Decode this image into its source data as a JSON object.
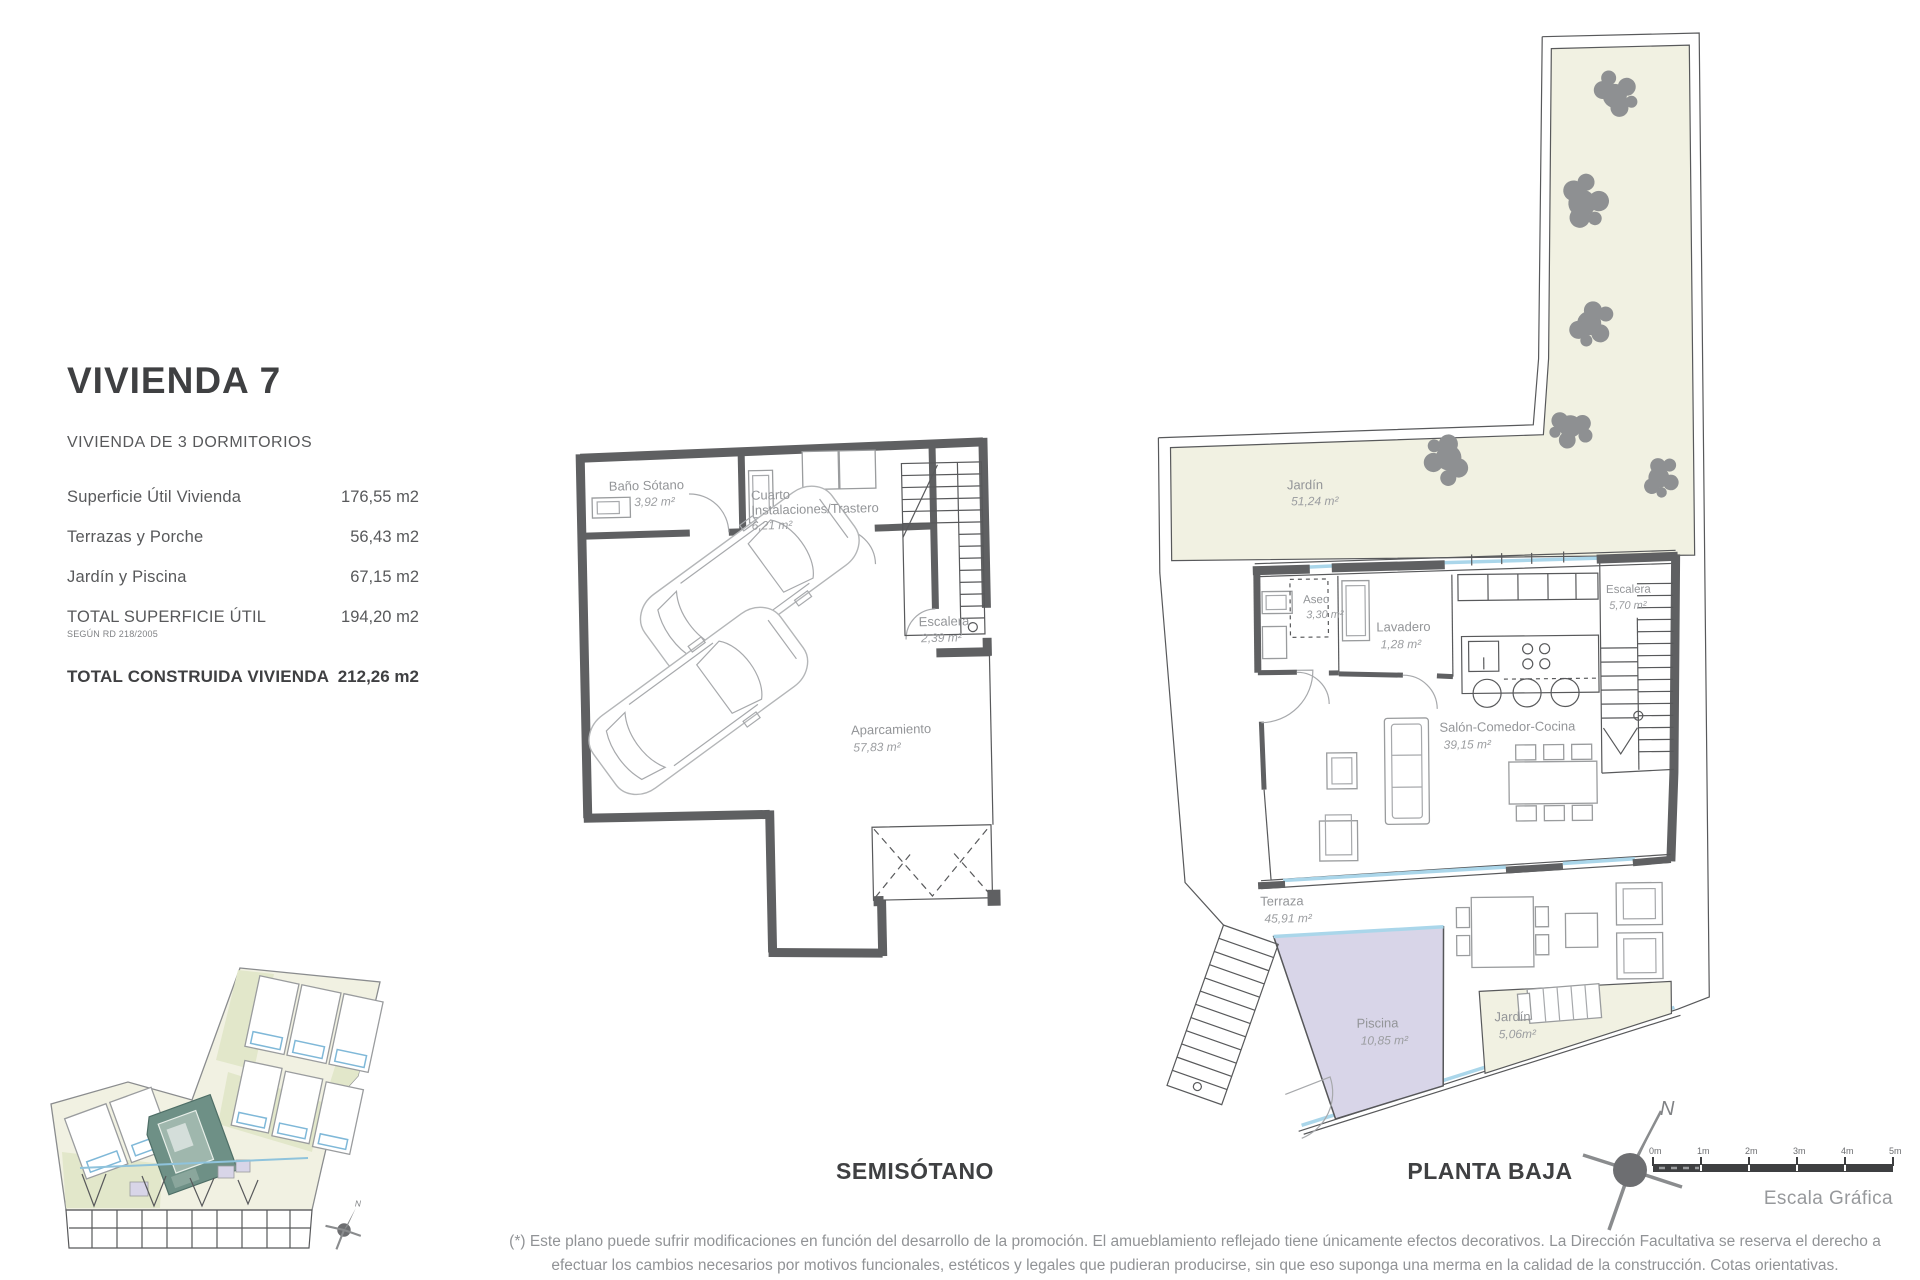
{
  "info": {
    "title": "VIVIENDA 7",
    "subtitle": "VIVIENDA DE 3 DORMITORIOS",
    "rows": [
      {
        "label": "Superficie Útil Vivienda",
        "value": "176,55 m2"
      },
      {
        "label": "Terrazas y Porche",
        "value": "56,43 m2"
      },
      {
        "label": "Jardín y Piscina",
        "value": "67,15 m2"
      },
      {
        "label": "TOTAL SUPERFICIE ÚTIL",
        "note": "SEGÚN RD 218/2005",
        "value": "194,20 m2"
      },
      {
        "label": "TOTAL CONSTRUIDA VIVIENDA",
        "value": "212,26 m2"
      }
    ]
  },
  "floors": {
    "semisotano": {
      "title": "SEMISÓTANO",
      "rooms": [
        {
          "name": "Baño Sótano",
          "area": "3,92 m²"
        },
        {
          "name": "Cuarto",
          "name2": "Instalaciones/Trastero",
          "area": "6,21 m²"
        },
        {
          "name": "Escalera",
          "area": "2,39 m²"
        },
        {
          "name": "Aparcamiento",
          "area": "57,83 m²"
        }
      ]
    },
    "planta_baja": {
      "title": "PLANTA BAJA",
      "rooms": [
        {
          "name": "Jardín",
          "area": "51,24 m²"
        },
        {
          "name": "Aseo",
          "area": "3,30 m²"
        },
        {
          "name": "Lavadero",
          "area": "1,28 m²"
        },
        {
          "name": "Escalera",
          "area": "5,70 m²"
        },
        {
          "name": "Salón-Comedor-Cocina",
          "area": "39,15 m²"
        },
        {
          "name": "Terraza",
          "area": "45,91 m²"
        },
        {
          "name": "Piscina",
          "area": "10,85 m²"
        },
        {
          "name": "Jardín",
          "area": "5,06m²"
        }
      ]
    }
  },
  "compass": {
    "north_label": "N"
  },
  "scale_bar": {
    "ticks": [
      "0m",
      "1m",
      "2m",
      "3m",
      "4m",
      "5m"
    ],
    "label": "Escala Gráfica"
  },
  "footnote": "(*) Este plano puede sufrir modificaciones en función del desarrollo de la promoción. El amueblamiento reflejado tiene únicamente efectos decorativos. La Dirección Facultativa se reserva el derecho a efectuar los cambios necesarios por motivos funcionales, estéticos y legales que pudieran producirse, sin que eso suponga una merma en la calidad de la construcción. Cotas orientativas.",
  "colors": {
    "wall": "#5f6062",
    "glazing": "#aad6ea",
    "garden_fill": "#f1f1e2",
    "green_fill": "#e2e7ca",
    "pool_fill": "#d8d5e8",
    "site_highlight": "#6e9086",
    "heading_text": "#3f4042",
    "body_text": "#58595b",
    "plan_label_text": "#939598"
  }
}
